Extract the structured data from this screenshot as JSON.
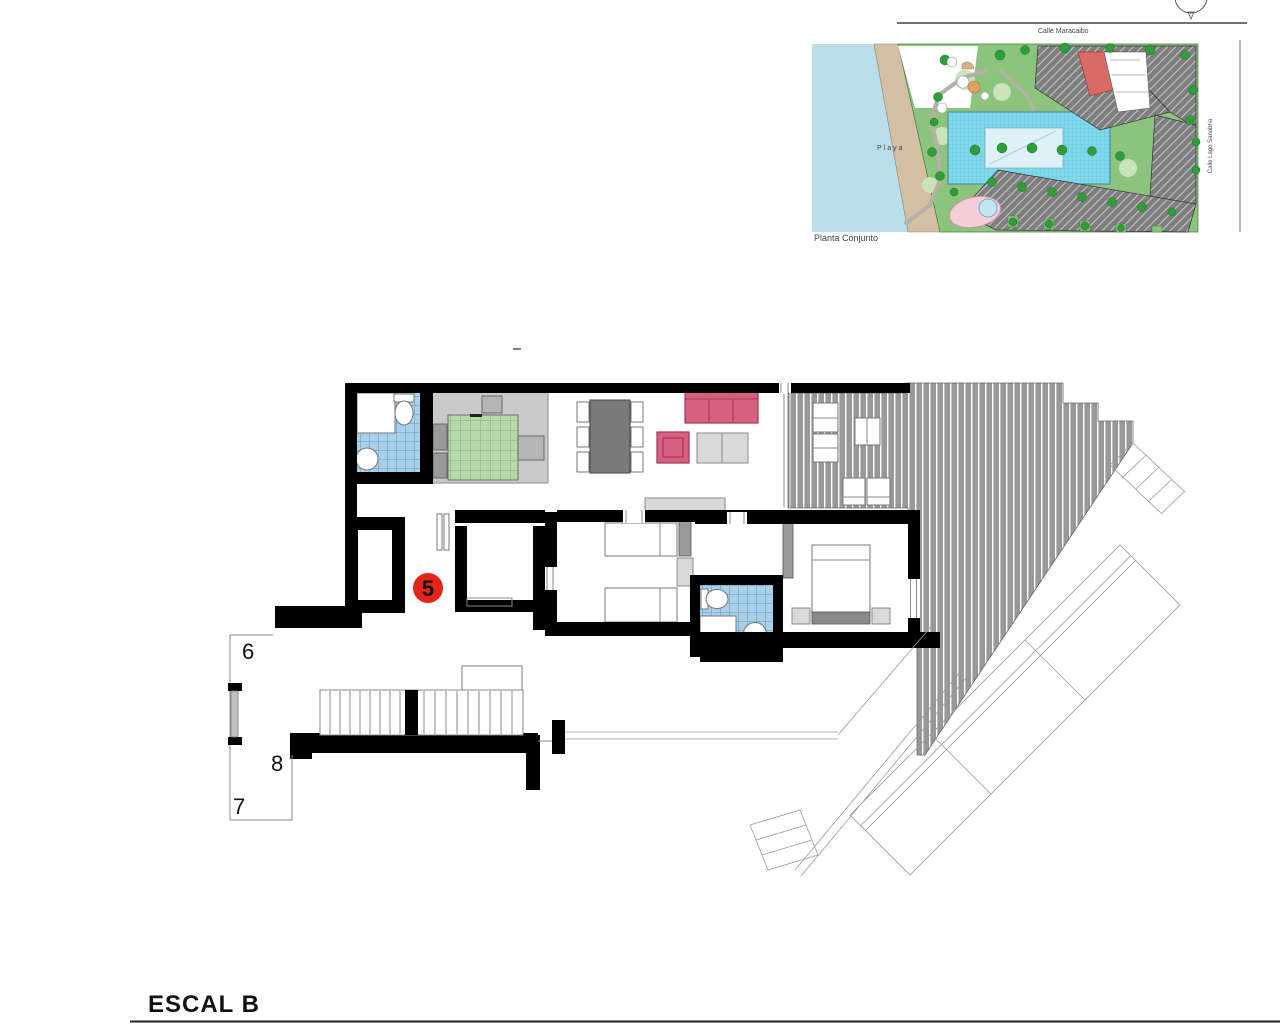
{
  "sheet": {
    "plan_label": "ESCAL B"
  },
  "site_plan": {
    "label": "Planta Conjunto",
    "street_top": "Calle Maracaibo",
    "street_right": "Calle Lago Sanabria",
    "beach_label": "Playa"
  },
  "floor_plan": {
    "unit_number": "5",
    "stair_label_6": "6",
    "stair_label_8": "8",
    "stair_label_7": "7"
  },
  "colors": {
    "wall_black": "#000000",
    "marker_red": "#e8231a",
    "tile_blue": "#a9cfe9",
    "tile_line": "#4f86b5",
    "bed_green": "#b6d9a9",
    "bed_green_line": "#74a369",
    "sofa_pink": "#d5617f",
    "sofa_pink_dark": "#a93355",
    "terrace_gray": "#989898",
    "floor_gray": "#c9c9c9",
    "furn_gray_dark": "#9a9a9a",
    "furn_gray_light": "#d9d9d9",
    "water_blue": "#b9dde9",
    "sand_tan": "#d2bfa4",
    "grass_green": "#8cc47e",
    "tree_green": "#2f9e3a",
    "pool_cyan": "#7fd9ea",
    "building_gray": "#7f7f7f",
    "building_red": "#d96a66",
    "blob_pink": "#f3cdd8"
  }
}
